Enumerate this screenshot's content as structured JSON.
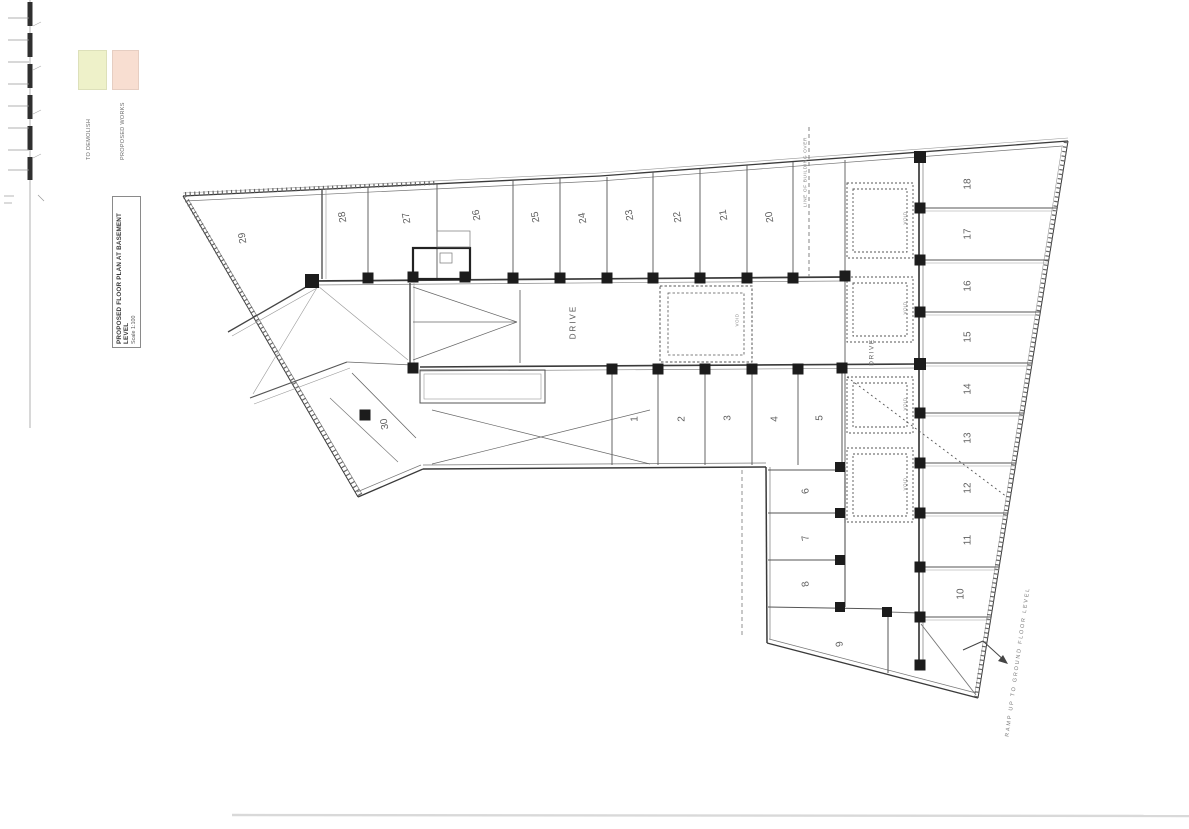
{
  "document": {
    "title": "PROPOSED FLOOR PLAN AT BASEMENT LEVEL",
    "scale": "Scale 1:100"
  },
  "legend": {
    "items": [
      {
        "name": "to-demolish",
        "color": "#eef1c9",
        "label": "TO DEMOLISH"
      },
      {
        "name": "proposed-works",
        "color": "#f8ded1",
        "label": "PROPOSED WORKS"
      }
    ]
  },
  "plan": {
    "background": "#ffffff",
    "stall_number_color": "#606060",
    "stalls": [
      [
        "29",
        243,
        238,
        -100
      ],
      [
        "28",
        343,
        217,
        -100
      ],
      [
        "27",
        407,
        218,
        -100
      ],
      [
        "26",
        477,
        215,
        -100
      ],
      [
        "25",
        536,
        217,
        -100
      ],
      [
        "24",
        583,
        218,
        -100
      ],
      [
        "23",
        630,
        215,
        -100
      ],
      [
        "22",
        678,
        217,
        -100
      ],
      [
        "21",
        724,
        215,
        -100
      ],
      [
        "20",
        770,
        217,
        -100
      ],
      [
        "30",
        385,
        424,
        -100
      ],
      [
        "1",
        635,
        419,
        -90
      ],
      [
        "2",
        682,
        419,
        -90
      ],
      [
        "3",
        728,
        418,
        -90
      ],
      [
        "4",
        775,
        419,
        -90
      ],
      [
        "5",
        820,
        418,
        -90
      ],
      [
        "6",
        806,
        491,
        -100
      ],
      [
        "7",
        806,
        538,
        -100
      ],
      [
        "8",
        806,
        584,
        -100
      ],
      [
        "9",
        840,
        644,
        -100
      ],
      [
        "10",
        961,
        594,
        -90
      ],
      [
        "11",
        968,
        540,
        -90
      ],
      [
        "12",
        968,
        488,
        -90
      ],
      [
        "13",
        968,
        438,
        -90
      ],
      [
        "14",
        968,
        389,
        -90
      ],
      [
        "15",
        968,
        337,
        -90
      ],
      [
        "16",
        968,
        286,
        -90
      ],
      [
        "17",
        968,
        234,
        -90
      ],
      [
        "18",
        968,
        184,
        -90
      ]
    ],
    "texts": [
      [
        573,
        322,
        "DRIVE",
        8,
        -90,
        "#555555",
        2
      ],
      [
        872,
        352,
        "DRIVE",
        6.5,
        -90,
        "#666666",
        1.5
      ],
      [
        905,
        218,
        "VOID",
        4.5,
        -90,
        "#888888",
        0.5
      ],
      [
        905,
        308,
        "VOID",
        4.5,
        -90,
        "#888888",
        0.5
      ],
      [
        905,
        404,
        "VOID",
        4.5,
        -90,
        "#888888",
        0.5
      ],
      [
        905,
        484,
        "VOID",
        4.5,
        -90,
        "#888888",
        0.5
      ],
      [
        737,
        320,
        "VOID",
        4.5,
        -90,
        "#888888",
        0.5
      ],
      [
        806,
        172,
        "LINE OF BUILDING OVER",
        4.8,
        -90,
        "#888888",
        0.6
      ],
      [
        1018,
        662,
        "RAMP UP TO GROUND FLOOR LEVEL",
        5.5,
        -82,
        "#777777",
        1.8
      ]
    ],
    "lines": [
      [
        183,
        196,
        600,
        176,
        1.3,
        "#3a3a3a"
      ],
      [
        600,
        176,
        1068,
        141,
        1.3,
        "#3a3a3a"
      ],
      [
        1068,
        141,
        978,
        698,
        1.0,
        "#3a3a3a"
      ],
      [
        978,
        698,
        767,
        643,
        1.3,
        "#3a3a3a"
      ],
      [
        767,
        643,
        766,
        467,
        1.5,
        "#3a3a3a"
      ],
      [
        766,
        467,
        423,
        469,
        1.5,
        "#3a3a3a"
      ],
      [
        423,
        469,
        358,
        497,
        1.3,
        "#3a3a3a"
      ],
      [
        358,
        497,
        183,
        196,
        1.0,
        "#3a3a3a"
      ],
      [
        185,
        201,
        600,
        181,
        0.7,
        "#777777"
      ],
      [
        600,
        181,
        1063,
        146,
        0.7,
        "#777777"
      ],
      [
        1062,
        147,
        975,
        693,
        0.6,
        "#999999"
      ],
      [
        976,
        693,
        769,
        639,
        0.7,
        "#777777"
      ],
      [
        770,
        639,
        770,
        467,
        0.7,
        "#777777"
      ],
      [
        766,
        463,
        423,
        465,
        0.7,
        "#777777"
      ],
      [
        421,
        465,
        357,
        492,
        0.7,
        "#777777"
      ],
      [
        362,
        494,
        188,
        199,
        0.7,
        "#777777"
      ],
      [
        183,
        193,
        600,
        173,
        0.6,
        "#999999"
      ],
      [
        600,
        173,
        1068,
        138,
        0.6,
        "#999999"
      ],
      [
        360,
        495,
        185,
        197,
        4.5,
        "#666666",
        "1.2,3.4"
      ],
      [
        1066,
        142,
        976,
        697,
        4.5,
        "#666666",
        "1.2,3.4"
      ],
      [
        185,
        194,
        435,
        183,
        4,
        "#666666",
        "1.2,3.4"
      ],
      [
        312,
        281,
        845,
        277,
        1.7,
        "#3a3a3a"
      ],
      [
        312,
        285,
        845,
        281,
        0.7,
        "#888888"
      ],
      [
        420,
        367,
        920,
        364,
        1.6,
        "#3a3a3a"
      ],
      [
        420,
        371,
        920,
        368,
        0.7,
        "#888888"
      ],
      [
        845,
        160,
        845,
        523,
        1.1,
        "#777777"
      ],
      [
        845,
        467,
        845,
        607,
        1.1,
        "#555555"
      ],
      [
        919,
        157,
        919,
        667,
        1.7,
        "#3a3a3a"
      ],
      [
        923,
        157,
        923,
        667,
        0.8,
        "#888888"
      ],
      [
        768,
        470,
        843,
        470,
        0.9,
        "#555555"
      ],
      [
        768,
        513,
        843,
        513,
        1.0,
        "#555555"
      ],
      [
        768,
        560,
        843,
        560,
        1.0,
        "#555555"
      ],
      [
        768,
        607,
        888,
        609,
        1.0,
        "#555555"
      ],
      [
        888,
        609,
        888,
        673,
        1.0,
        "#555555"
      ],
      [
        888,
        612,
        919,
        613,
        0.9,
        "#777777"
      ],
      [
        921,
        624,
        976,
        695,
        0.9,
        "#777777"
      ],
      [
        322,
        189,
        322,
        279,
        1.4,
        "#555555"
      ],
      [
        326,
        189,
        326,
        279,
        0.6,
        "#999999"
      ],
      [
        368,
        187,
        368,
        279,
        0.9,
        "#555555"
      ],
      [
        437,
        184,
        437,
        279,
        0.9,
        "#555555"
      ],
      [
        513,
        180,
        513,
        279,
        0.9,
        "#555555"
      ],
      [
        560,
        178,
        560,
        279,
        0.9,
        "#555555"
      ],
      [
        607,
        177,
        607,
        279,
        0.9,
        "#555555"
      ],
      [
        653,
        172,
        653,
        279,
        0.9,
        "#555555"
      ],
      [
        700,
        169,
        700,
        279,
        0.9,
        "#555555"
      ],
      [
        747,
        165,
        747,
        279,
        0.9,
        "#555555"
      ],
      [
        793,
        162,
        793,
        279,
        0.9,
        "#555555"
      ],
      [
        612,
        372,
        612,
        465,
        0.9,
        "#555555"
      ],
      [
        658,
        372,
        658,
        465,
        0.9,
        "#555555"
      ],
      [
        705,
        372,
        705,
        465,
        0.9,
        "#555555"
      ],
      [
        752,
        372,
        752,
        465,
        0.9,
        "#555555"
      ],
      [
        798,
        372,
        798,
        465,
        0.9,
        "#555555"
      ],
      [
        842,
        372,
        842,
        465,
        1.0,
        "#555555"
      ],
      [
        925,
        208,
        1057,
        208,
        1.0,
        "#555555"
      ],
      [
        925,
        211,
        1057,
        211,
        0.5,
        "#999999"
      ],
      [
        925,
        260,
        1049,
        260,
        1.0,
        "#555555"
      ],
      [
        925,
        263,
        1049,
        263,
        0.5,
        "#999999"
      ],
      [
        925,
        312,
        1040,
        312,
        1.0,
        "#555555"
      ],
      [
        925,
        315,
        1040,
        315,
        0.5,
        "#999999"
      ],
      [
        925,
        363,
        1032,
        363,
        1.0,
        "#555555"
      ],
      [
        925,
        366,
        1032,
        366,
        0.5,
        "#999999"
      ],
      [
        925,
        413,
        1024,
        413,
        1.0,
        "#555555"
      ],
      [
        925,
        416,
        1024,
        416,
        0.5,
        "#999999"
      ],
      [
        925,
        463,
        1016,
        463,
        1.0,
        "#555555"
      ],
      [
        925,
        466,
        1016,
        466,
        0.5,
        "#999999"
      ],
      [
        925,
        513,
        1008,
        513,
        1.0,
        "#555555"
      ],
      [
        925,
        516,
        1008,
        516,
        0.5,
        "#999999"
      ],
      [
        925,
        567,
        999,
        567,
        1.0,
        "#555555"
      ],
      [
        925,
        570,
        999,
        570,
        0.5,
        "#999999"
      ],
      [
        925,
        617,
        991,
        617,
        1.0,
        "#555555"
      ],
      [
        925,
        620,
        991,
        620,
        0.5,
        "#999999"
      ],
      [
        313,
        283,
        228,
        332,
        1.3,
        "#444444"
      ],
      [
        317,
        288,
        232,
        336,
        0.6,
        "#999999"
      ],
      [
        250,
        398,
        347,
        362,
        1.1,
        "#555555"
      ],
      [
        254,
        404,
        350,
        368,
        0.6,
        "#999999"
      ],
      [
        347,
        362,
        412,
        365,
        0.8,
        "#666666"
      ],
      [
        352,
        373,
        416,
        438,
        0.8,
        "#666666"
      ],
      [
        330,
        398,
        398,
        462,
        0.7,
        "#777777"
      ],
      [
        410,
        283,
        410,
        363,
        1.4,
        "#444444"
      ],
      [
        414,
        283,
        414,
        363,
        0.6,
        "#999999"
      ],
      [
        520,
        290,
        520,
        363,
        0.9,
        "#666666"
      ],
      [
        318,
        286,
        408,
        360,
        0.6,
        "#999999"
      ],
      [
        318,
        286,
        253,
        394,
        0.6,
        "#999999"
      ],
      [
        413,
        287,
        517,
        322,
        0.7,
        "#666666"
      ],
      [
        413,
        322,
        517,
        322,
        0.7,
        "#666666"
      ],
      [
        413,
        360,
        517,
        322,
        0.7,
        "#666666"
      ],
      [
        432,
        410,
        650,
        464,
        0.7,
        "#666666"
      ],
      [
        432,
        464,
        650,
        410,
        0.7,
        "#666666"
      ],
      [
        963,
        650,
        983,
        641,
        1.0,
        "#444444"
      ],
      [
        983,
        641,
        1006,
        662,
        1.0,
        "#444444"
      ],
      [
        809,
        127,
        809,
        277,
        0.9,
        "#777777",
        "4,3"
      ],
      [
        742,
        470,
        742,
        638,
        0.8,
        "#777777",
        "4,3"
      ],
      [
        847,
        377,
        1007,
        497,
        0.9,
        "#555555",
        "2,3"
      ],
      [
        30,
        0,
        30,
        428,
        0.9,
        "#aaaaaa"
      ],
      [
        30,
        2,
        30,
        180,
        5,
        "#2f2f2f",
        "24,7"
      ],
      [
        8,
        18,
        29,
        18,
        0.7,
        "#999999"
      ],
      [
        8,
        40,
        29,
        40,
        0.7,
        "#999999"
      ],
      [
        8,
        62,
        29,
        62,
        0.7,
        "#999999"
      ],
      [
        8,
        84,
        29,
        84,
        0.7,
        "#999999"
      ],
      [
        8,
        106,
        29,
        106,
        0.7,
        "#999999"
      ],
      [
        8,
        128,
        29,
        128,
        0.7,
        "#999999"
      ],
      [
        8,
        150,
        29,
        150,
        0.7,
        "#999999"
      ],
      [
        8,
        170,
        29,
        170,
        0.7,
        "#999999"
      ],
      [
        33,
        26,
        41,
        22,
        0.6,
        "#aaaaaa"
      ],
      [
        33,
        70,
        41,
        66,
        0.6,
        "#aaaaaa"
      ],
      [
        33,
        114,
        41,
        110,
        0.6,
        "#aaaaaa"
      ],
      [
        33,
        158,
        41,
        154,
        0.6,
        "#aaaaaa"
      ],
      [
        4,
        196,
        14,
        196,
        0.7,
        "#999999"
      ],
      [
        4,
        203,
        12,
        203,
        0.7,
        "#999999"
      ],
      [
        38,
        195,
        44,
        201,
        0.7,
        "#999999"
      ],
      [
        232,
        815,
        1189,
        816,
        2.4,
        "#d9d9d9"
      ]
    ],
    "rects": [
      [
        413,
        248,
        57,
        31,
        2.2,
        "#222222"
      ],
      [
        440,
        253,
        12,
        10,
        0.7,
        "#777777"
      ],
      [
        437,
        231,
        33,
        16,
        0.7,
        "#777777"
      ],
      [
        420,
        370,
        125,
        33,
        1.0,
        "#555555"
      ],
      [
        424,
        374,
        117,
        25,
        0.6,
        "#999999"
      ],
      [
        847,
        183,
        66,
        75,
        0.9,
        "#555555",
        "2,2"
      ],
      [
        853,
        189,
        54,
        63,
        0.9,
        "#555555",
        "2,2"
      ],
      [
        847,
        277,
        66,
        65,
        0.9,
        "#555555",
        "2,2"
      ],
      [
        853,
        283,
        54,
        53,
        0.9,
        "#555555",
        "2,2"
      ],
      [
        847,
        377,
        66,
        56,
        0.9,
        "#555555",
        "2,2"
      ],
      [
        853,
        383,
        54,
        44,
        0.9,
        "#555555",
        "2,2"
      ],
      [
        847,
        448,
        66,
        74,
        0.9,
        "#555555",
        "2,2"
      ],
      [
        853,
        454,
        54,
        62,
        0.9,
        "#555555",
        "2,2"
      ],
      [
        660,
        286,
        92,
        76,
        1.0,
        "#555555",
        "2.5,2"
      ],
      [
        668,
        293,
        76,
        62,
        0.8,
        "#555555",
        "2.5,2"
      ]
    ],
    "columns": [
      [
        312,
        281,
        14
      ],
      [
        368,
        278,
        11
      ],
      [
        413,
        277,
        11
      ],
      [
        465,
        277,
        11
      ],
      [
        513,
        278,
        11
      ],
      [
        560,
        278,
        11
      ],
      [
        607,
        278,
        11
      ],
      [
        653,
        278,
        11
      ],
      [
        700,
        278,
        11
      ],
      [
        747,
        278,
        11
      ],
      [
        793,
        278,
        11
      ],
      [
        845,
        276,
        11
      ],
      [
        413,
        368,
        11
      ],
      [
        612,
        369,
        11
      ],
      [
        658,
        369,
        11
      ],
      [
        705,
        369,
        11
      ],
      [
        752,
        369,
        11
      ],
      [
        798,
        369,
        11
      ],
      [
        842,
        368,
        11
      ],
      [
        920,
        157,
        12
      ],
      [
        920,
        208,
        11
      ],
      [
        920,
        260,
        11
      ],
      [
        920,
        312,
        11
      ],
      [
        920,
        364,
        12
      ],
      [
        920,
        413,
        11
      ],
      [
        920,
        463,
        11
      ],
      [
        920,
        513,
        11
      ],
      [
        920,
        567,
        11
      ],
      [
        920,
        617,
        11
      ],
      [
        920,
        665,
        11
      ],
      [
        840,
        467,
        10
      ],
      [
        840,
        513,
        10
      ],
      [
        840,
        560,
        10
      ],
      [
        840,
        607,
        10
      ],
      [
        887,
        612,
        10
      ],
      [
        365,
        415,
        11
      ]
    ],
    "polygons": [
      {
        "points": "1008,664 998,661 1003,655",
        "fill": "#444444"
      }
    ]
  }
}
